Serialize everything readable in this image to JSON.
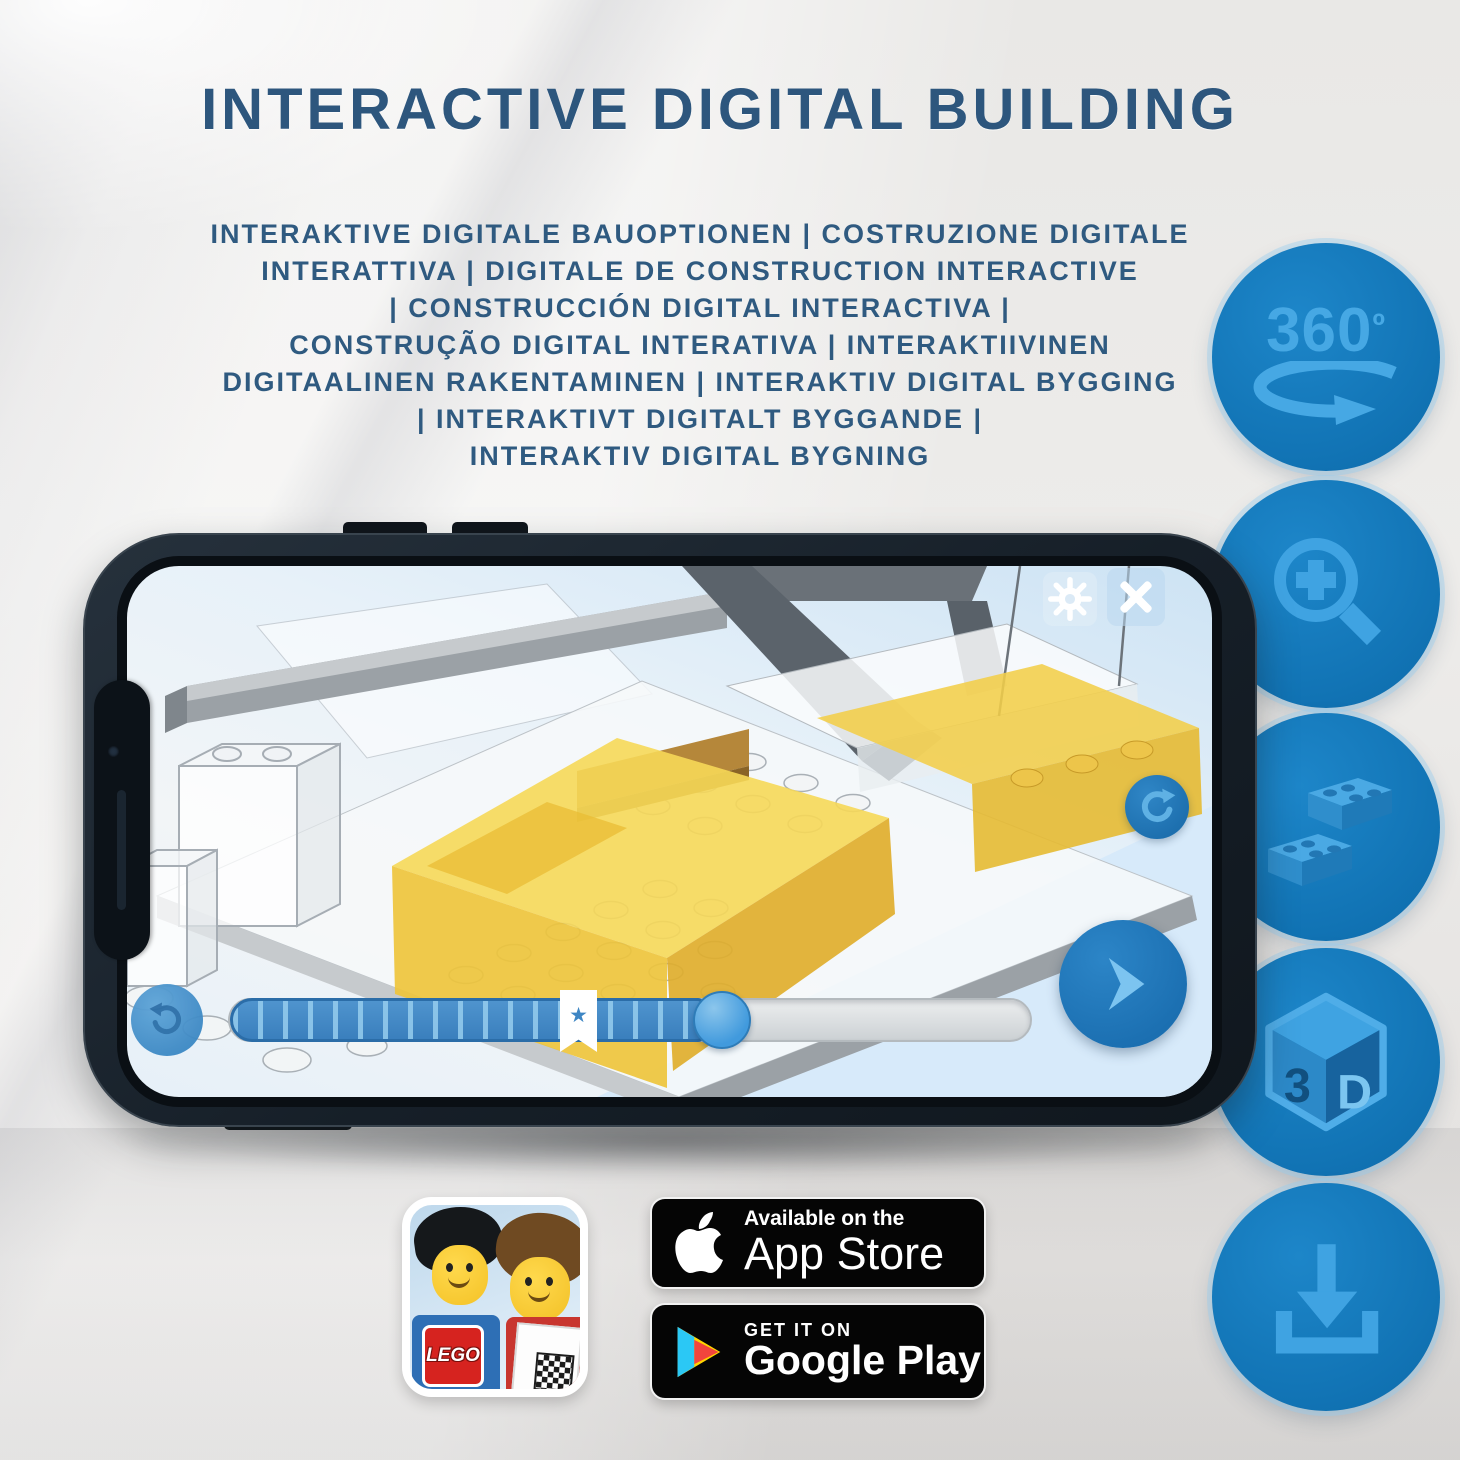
{
  "title": "INTERACTIVE DIGITAL BUILDING",
  "subtitle": {
    "lines": [
      "INTERAKTIVE DIGITALE BAUOPTIONEN | COSTRUZIONE DIGITALE",
      "INTERATTIVA | DIGITALE DE CONSTRUCTION INTERACTIVE",
      "| CONSTRUCCIÓN DIGITAL INTERACTIVA |",
      "CONSTRUÇÃO DIGITAL INTERATIVA | INTERAKTIIVINEN",
      "DIGITAALINEN RAKENTAMINEN | INTERAKTIV DIGITAL BYGGING",
      "| INTERAKTIVT DIGITALT BYGGANDE |",
      "INTERAKTIV DIGITAL BYGNING"
    ]
  },
  "feature_badges": {
    "rotate_360": {
      "value": "360",
      "degree": "º"
    },
    "cube_3d": {
      "left": "3",
      "right": "D"
    }
  },
  "store": {
    "app_store": {
      "tagline": "Available on the",
      "name": "App Store"
    },
    "google_play": {
      "tagline": "GET IT ON",
      "name": "Google Play"
    },
    "lego_icon": {
      "logo": "LEGO"
    }
  },
  "slider": {
    "star": "★"
  },
  "colors": {
    "title_blue": "#2d567d",
    "circle_blue": "#1173b4",
    "icon_light_blue": "#3fa3e2",
    "slider_blue": "#3e86c4",
    "brick_yellow": "#f2cd49",
    "badge_black": "#050505"
  }
}
